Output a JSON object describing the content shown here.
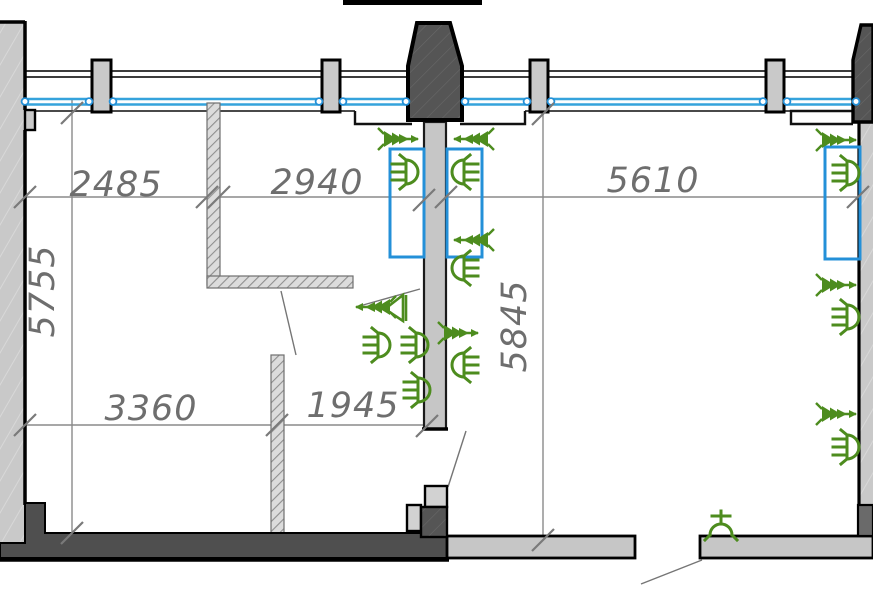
{
  "drawing": {
    "type": "architectural-floor-plan-fragment",
    "dims": {
      "d2485": "2485",
      "d2940": "2940",
      "d5610": "5610",
      "d5755": "5755",
      "d5845": "5845",
      "d3360": "3360",
      "d1945": "1945"
    },
    "colors": {
      "glazing_blue": "#35a3dc",
      "zone_rect_blue": "#2490d8",
      "fixture_green": "#4d8c1e",
      "wall_dark": "#4f4f4f",
      "shaft_dark": "#555555",
      "wall_light": "#c9c9c9",
      "partition_hatch_bg": "#dcdcdc",
      "dimension_gray": "#6e6e6e"
    },
    "icons": {
      "socket_outlet": "socket-outlet-icon",
      "wall_fixture_arrow": "fixture-arrow-icon",
      "dome_lamp": "dome-lamp-icon",
      "horn_speaker": "horn-speaker-icon"
    }
  }
}
